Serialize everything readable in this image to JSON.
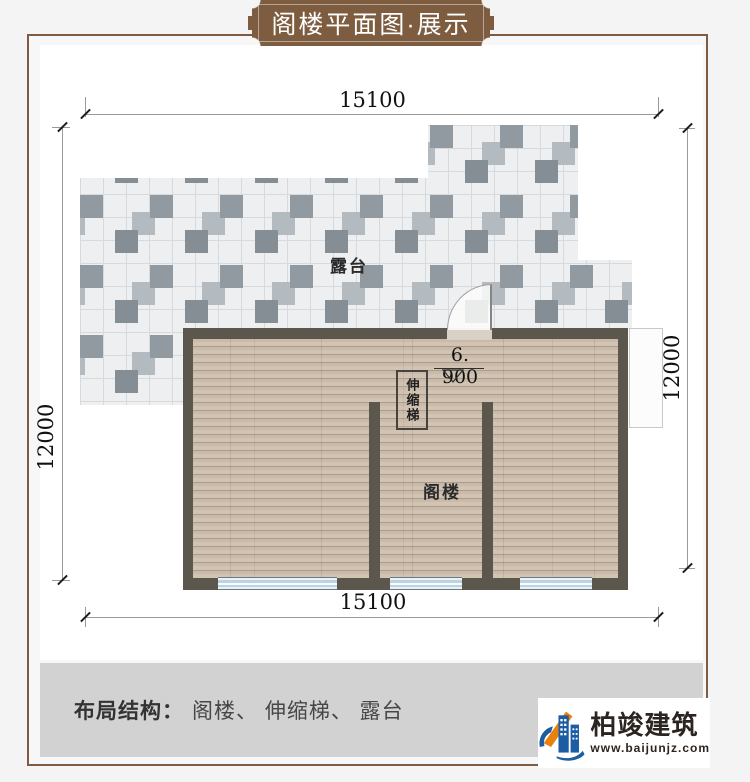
{
  "banner": {
    "title": "阁楼平面图·展示"
  },
  "dimensions": {
    "top": "15100",
    "bottom": "15100",
    "left": "12000",
    "right": "12000"
  },
  "plan": {
    "terrace_label": "露台",
    "attic_label": "阁楼",
    "ladder_label": "伸缩梯",
    "elevation": "6. 900"
  },
  "footer": {
    "label": "布局结构：",
    "items": "阁楼、 伸缩梯、 露台"
  },
  "logo": {
    "name": "柏竣建筑",
    "website": "www.baijunjz.com"
  },
  "colors": {
    "page_bg": "#f4f4f5",
    "banner_brown": "#7d5c40",
    "frame_brown": "#7e5c43",
    "wall_dark": "#5c574d",
    "wood_floor": "#cfc0af",
    "tile_dark": "#8f979e",
    "window_blue": "#bdd3e0",
    "footer_gray": "#d2d2d2",
    "logo_blue": "#1b5ca3",
    "logo_orange": "#e8820e"
  }
}
